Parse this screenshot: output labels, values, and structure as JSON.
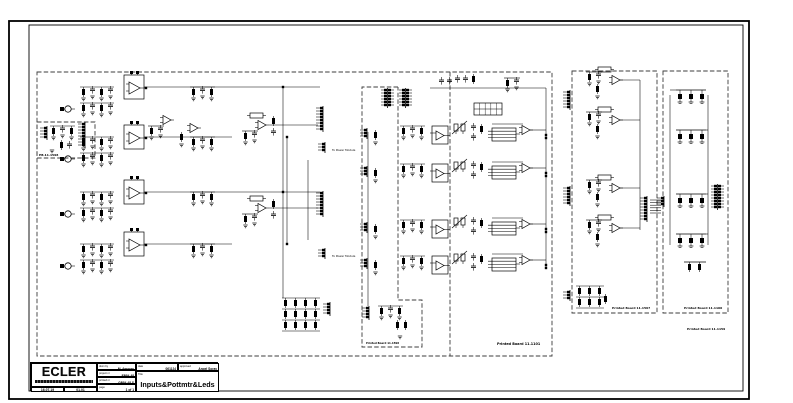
{
  "drawing": {
    "board_labels": {
      "input_board_small": "PB.11.1598",
      "main_board": "Printed Board 11.1101",
      "mid_sub_board": "Printed Board 11.1598",
      "pot_board": "Printed Board 11.1597",
      "led_board": "Printed Board 11.1100",
      "led_board_alt": "Printed Board 11.1159"
    },
    "wire_labels": {
      "to_power_module_1": "To Power Module",
      "to_power_module_2": "To Power Module"
    }
  },
  "title_block": {
    "logo_text": "ECLER",
    "fields": {
      "drawn_by_label": "drwn by",
      "drawn_by": "M. Amores",
      "date_label": "date",
      "date": "061124",
      "approved_label": "approved",
      "approved": "Angel Soray",
      "project_label": "project nr",
      "project": "EP84-48",
      "printed_label": "printed nr",
      "printed": "GP84-48 S",
      "page_label": "page",
      "page": "1 of 1",
      "title_label": "Title",
      "title": "Inputs&Pottmtr&Leds",
      "rev_date_1": "16.07.19",
      "rev_date_2": "01.01"
    }
  }
}
